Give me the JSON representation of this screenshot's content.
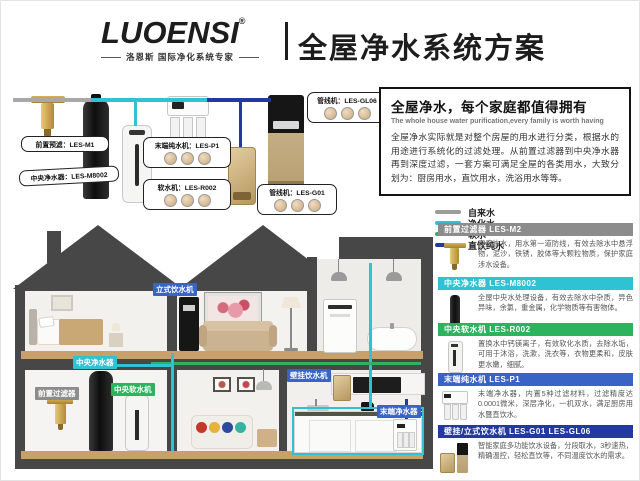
{
  "header": {
    "logo": "LUOENSI",
    "registered": "®",
    "tagline": "洛恩斯 国际净化系统专家",
    "title": "全屋净水系统方案"
  },
  "intro": {
    "title": "全屋净水，每个家庭都值得拥有",
    "subtitle": "The whole house water purification,every family is worth having",
    "body": "全屋净水实际就是对整个房屋的用水进行分类，根据水的用途进行系统化的过滤处理。从前置过滤器到中央净水器再到深度过滤，一套方案可满足全屋的各类用水，大致分划为：厨房用水，直饮用水，洗浴用水等等。"
  },
  "legend": [
    {
      "label": "自来水",
      "color": "#9c9c9c"
    },
    {
      "label": "净化水",
      "color": "#2fc1d4"
    },
    {
      "label": "软水",
      "color": "#2db35e"
    },
    {
      "label": "直饮纯水",
      "color": "#24399f"
    }
  ],
  "diagram": {
    "callouts": [
      {
        "label": "前置预滤：LES-M1"
      },
      {
        "label": "中央净水器：LES-M8002"
      },
      {
        "label": "末端纯水机：LES-P1"
      },
      {
        "label": "软水机：LES-R002"
      },
      {
        "label": "管线机：LES-GL06"
      },
      {
        "label": "管线机：LES-G01"
      }
    ]
  },
  "products": [
    {
      "name": "前置过滤器 LES-M2",
      "color": "#8c8c8c",
      "desc": "家庭饮水，用水第一道防线，有效去除水中悬浮物，泥沙，铁锈，胶体等大颗粒物质，保护家庭涉水设备。"
    },
    {
      "name": "中央净水器 LES-M8002",
      "color": "#2fc1d4",
      "desc": "全屋中央水处理设备，有效去除水中杂质，异色异味，余氯，重金属，化学物质等有害物体。"
    },
    {
      "name": "中央软水机 LES-R002",
      "color": "#2db35e",
      "desc": "置换水中钙镁离子，有效软化水质，去除水垢，可用于沐浴，洗漱，洗衣等，衣物更柔和，皮肤更水嫩，细腻。"
    },
    {
      "name": "末端纯水机 LES-P1",
      "color": "#3a63c6",
      "desc": "末端净水器，内置5种过滤材料，过滤精度达0.0001微米，深层净化，一机双水，满足厨房用水暨直饮水。"
    },
    {
      "name": "壁挂/立式饮水机 LES-G01 LES-GL06",
      "color": "#24399f",
      "desc": "智能家庭多功能饮水设备，分段取水，3秒速热，精确温控，轻松直饮等，不同温度饮水的需求。"
    }
  ],
  "house": {
    "badges": [
      {
        "label": "立式饮水机",
        "color": "#3a63c6"
      },
      {
        "label": "中央净水器",
        "color": "#2fc1d4"
      },
      {
        "label": "前置过滤器",
        "color": "#8c8c8c"
      },
      {
        "label": "中央软水机",
        "color": "#2db35e"
      },
      {
        "label": "壁挂饮水机",
        "color": "#3a63c6"
      },
      {
        "label": "末端净水器",
        "color": "#3a63c6"
      }
    ]
  }
}
